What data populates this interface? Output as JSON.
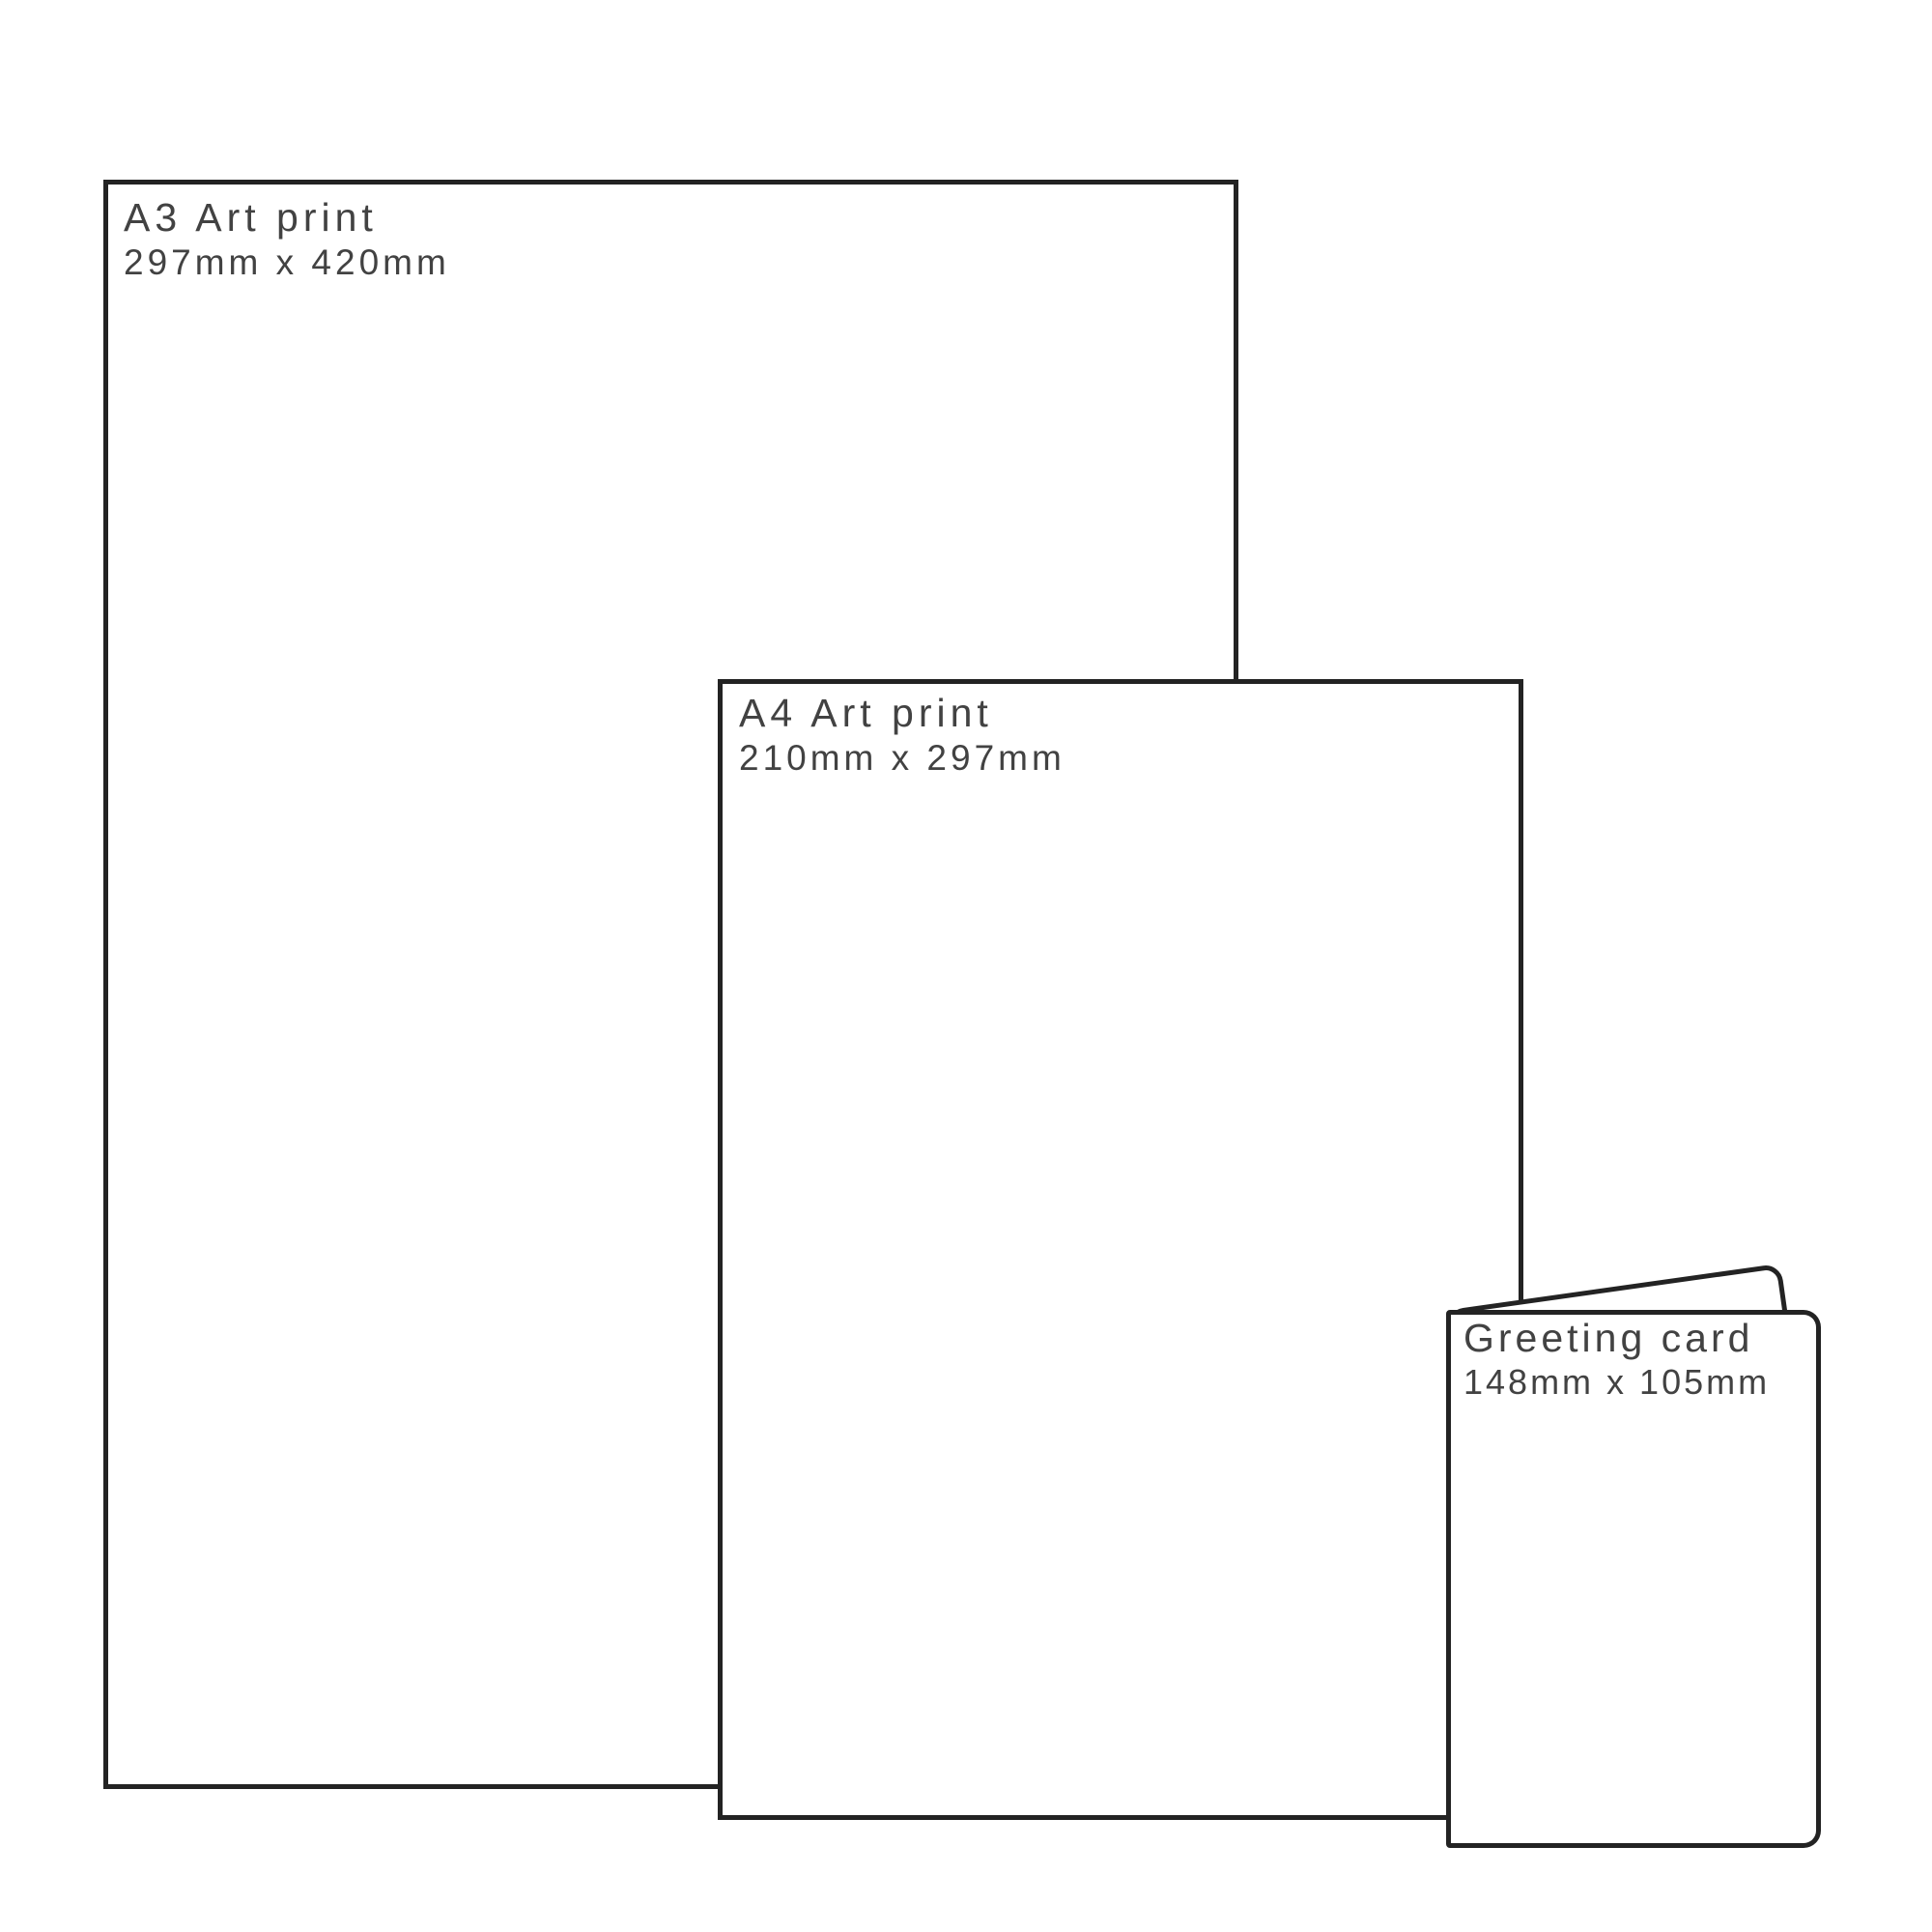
{
  "diagram": {
    "description": "Print product size comparison",
    "background": "#ffffff",
    "outline_color": "#232323",
    "text_color": "#424242"
  },
  "products": [
    {
      "title": "A3 Art print",
      "dimensions": "297mm x 420mm"
    },
    {
      "title": "A4 Art print",
      "dimensions": "210mm x 297mm"
    },
    {
      "title": "Greeting card",
      "dimensions": "148mm x 105mm"
    }
  ]
}
